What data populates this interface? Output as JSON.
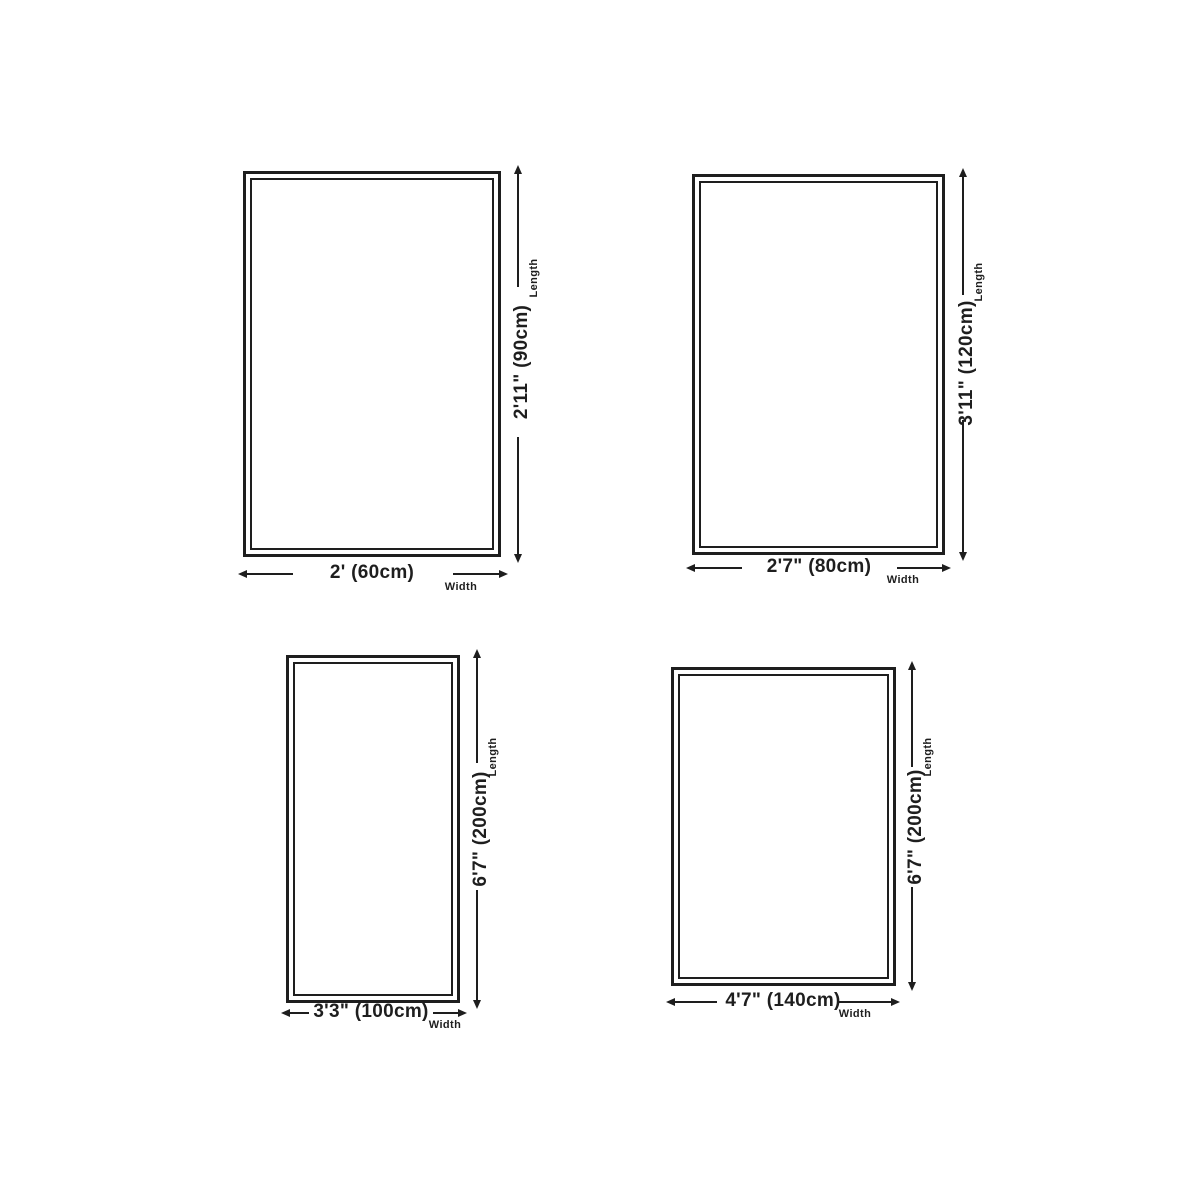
{
  "canvas": {
    "background": "#ffffff",
    "line_color": "#1e1e1e"
  },
  "diagrams": [
    {
      "name": "rug-size-60x90",
      "length_label": "2'11\" (90cm)",
      "width_label": "2' (60cm)",
      "length_caption": "Length",
      "width_caption": "Width"
    },
    {
      "name": "rug-size-80x120",
      "length_label": "3'11\" (120cm)",
      "width_label": "2'7\" (80cm)",
      "length_caption": "Length",
      "width_caption": "Width"
    },
    {
      "name": "rug-size-100x200",
      "length_label": "6'7\" (200cm)",
      "width_label": "3'3\" (100cm)",
      "length_caption": "Length",
      "width_caption": "Width"
    },
    {
      "name": "rug-size-140x200",
      "length_label": "6'7\" (200cm)",
      "width_label": "4'7\" (140cm)",
      "length_caption": "Length",
      "width_caption": "Width"
    }
  ]
}
